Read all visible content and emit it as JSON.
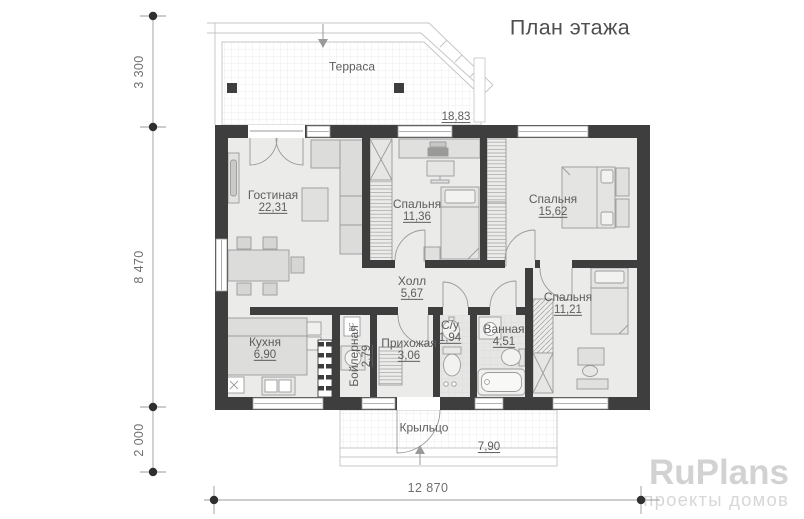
{
  "title": "План этажа",
  "rooms": [
    {
      "name": "Терраса",
      "area": "18,83"
    },
    {
      "name": "Гостиная",
      "area": "22,31"
    },
    {
      "name": "Спальня",
      "area": "11,36"
    },
    {
      "name": "Спальня",
      "area": "15,62"
    },
    {
      "name": "Холл",
      "area": "5,67"
    },
    {
      "name": "Кухня",
      "area": "6,90"
    },
    {
      "name": "Бойлерная",
      "area": "2,79"
    },
    {
      "name": "Прихожая",
      "area": "3,06"
    },
    {
      "name": "С/у",
      "area": "1,94"
    },
    {
      "name": "Ванная",
      "area": "4,51"
    },
    {
      "name": "Спальня",
      "area": "11,21"
    },
    {
      "name": "Крыльцо",
      "area": "7,90"
    }
  ],
  "equipment": {
    "water_supply_label": "ВС"
  },
  "dimensions": {
    "left_top": "3 300",
    "left_middle": "8 470",
    "left_bottom": "2 000",
    "bottom_width": "12 870"
  },
  "watermark": {
    "brand": "RuPlans",
    "tagline": "проекты домов"
  },
  "colors": {
    "wall": "#3e3e3e",
    "floor": "#ebebe9",
    "dimension": "#6f6f6f",
    "watermark": "#d2d2d2"
  }
}
